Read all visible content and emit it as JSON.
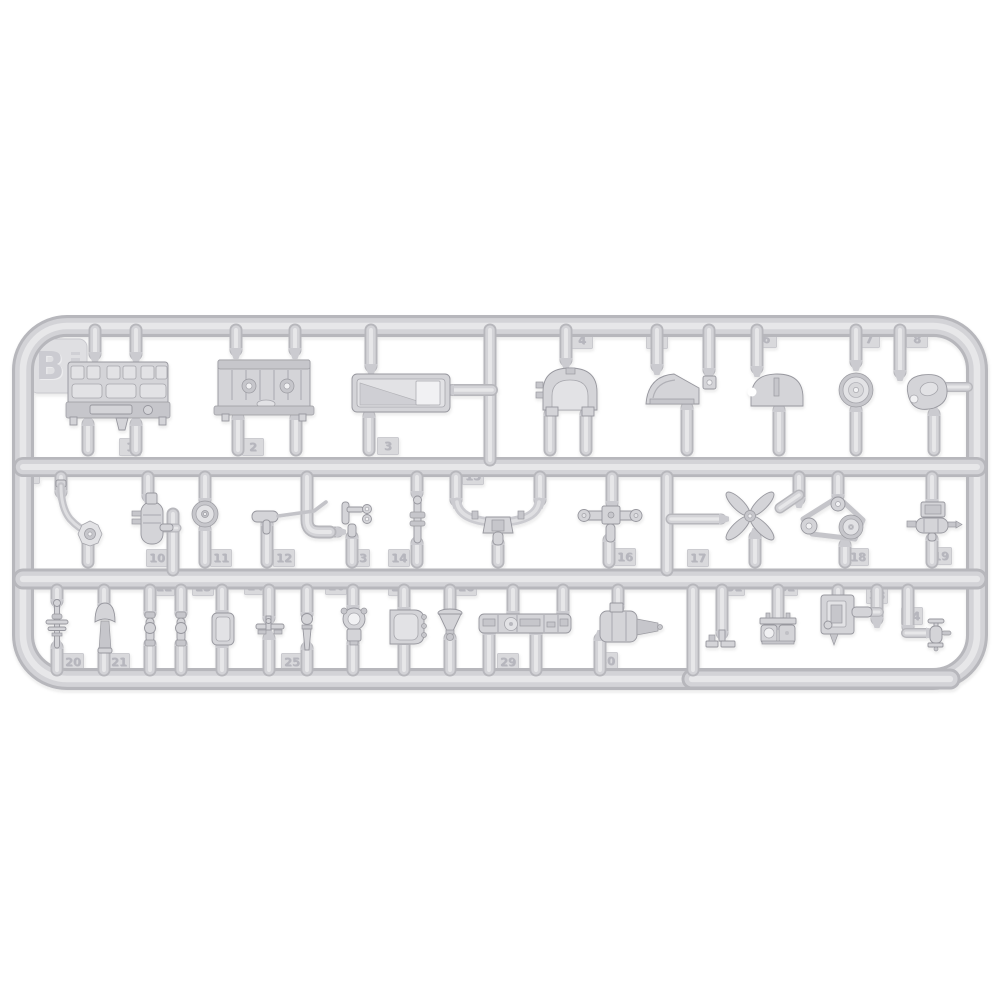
{
  "sprue": {
    "letter": "B",
    "tabs": [
      {
        "n": "1",
        "x": 130,
        "y": 447
      },
      {
        "n": "2",
        "x": 253,
        "y": 447
      },
      {
        "n": "3",
        "x": 388,
        "y": 446
      },
      {
        "n": "4",
        "x": 582,
        "y": 340
      },
      {
        "n": "5",
        "x": 657,
        "y": 340
      },
      {
        "n": "6",
        "x": 766,
        "y": 339
      },
      {
        "n": "7",
        "x": 869,
        "y": 339
      },
      {
        "n": "8",
        "x": 917,
        "y": 339
      },
      {
        "n": "9",
        "x": 29,
        "y": 475
      },
      {
        "n": "10",
        "x": 157,
        "y": 558
      },
      {
        "n": "11",
        "x": 221,
        "y": 558
      },
      {
        "n": "12",
        "x": 284,
        "y": 558
      },
      {
        "n": "13",
        "x": 359,
        "y": 558
      },
      {
        "n": "14",
        "x": 399,
        "y": 558
      },
      {
        "n": "15",
        "x": 473,
        "y": 476
      },
      {
        "n": "16",
        "x": 625,
        "y": 557
      },
      {
        "n": "17",
        "x": 698,
        "y": 558
      },
      {
        "n": "18",
        "x": 858,
        "y": 557
      },
      {
        "n": "19",
        "x": 941,
        "y": 556
      },
      {
        "n": "20",
        "x": 73,
        "y": 662
      },
      {
        "n": "21",
        "x": 119,
        "y": 662
      },
      {
        "n": "22",
        "x": 164,
        "y": 587
      },
      {
        "n": "23",
        "x": 203,
        "y": 587
      },
      {
        "n": "24",
        "x": 255,
        "y": 586
      },
      {
        "n": "25",
        "x": 292,
        "y": 662
      },
      {
        "n": "26",
        "x": 336,
        "y": 586
      },
      {
        "n": "27",
        "x": 399,
        "y": 587
      },
      {
        "n": "28",
        "x": 466,
        "y": 587
      },
      {
        "n": "29",
        "x": 508,
        "y": 662
      },
      {
        "n": "30",
        "x": 607,
        "y": 661
      },
      {
        "n": "31",
        "x": 734,
        "y": 587
      },
      {
        "n": "32",
        "x": 787,
        "y": 587
      },
      {
        "n": "33",
        "x": 877,
        "y": 595
      },
      {
        "n": "34",
        "x": 912,
        "y": 616
      }
    ],
    "parts": [
      {
        "num": 1,
        "name": "engine-cylinder-head"
      },
      {
        "num": 2,
        "name": "engine-block"
      },
      {
        "num": 3,
        "name": "oil-sump-pan"
      },
      {
        "num": 4,
        "name": "flywheel-housing"
      },
      {
        "num": 5,
        "name": "side-cover"
      },
      {
        "num": 6,
        "name": "semicircular-cover"
      },
      {
        "num": 7,
        "name": "pulley-wheel"
      },
      {
        "num": 8,
        "name": "mount-plate"
      },
      {
        "num": 9,
        "name": "exhaust-elbow-pipe"
      },
      {
        "num": 10,
        "name": "oil-filter-canister"
      },
      {
        "num": 11,
        "name": "small-pulley"
      },
      {
        "num": 12,
        "name": "control-rod-pipe"
      },
      {
        "num": 13,
        "name": "clamp-bracket"
      },
      {
        "num": 14,
        "name": "small-linkage"
      },
      {
        "num": 15,
        "name": "intake-manifold"
      },
      {
        "num": 16,
        "name": "handle-bar"
      },
      {
        "num": 17,
        "name": "cooling-fan"
      },
      {
        "num": 18,
        "name": "belt-pulley-set"
      },
      {
        "num": 19,
        "name": "generator"
      },
      {
        "num": 20,
        "name": "valve-linkage"
      },
      {
        "num": 21,
        "name": "air-horn"
      },
      {
        "num": 22,
        "name": "link-barrel-a"
      },
      {
        "num": 23,
        "name": "link-barrel-b"
      },
      {
        "num": 24,
        "name": "cover-plate"
      },
      {
        "num": 25,
        "name": "small-bracket"
      },
      {
        "num": 26,
        "name": "finial-knob"
      },
      {
        "num": 27,
        "name": "filler-clamp"
      },
      {
        "num": 28,
        "name": "access-cover"
      },
      {
        "num": 29,
        "name": "funnel"
      },
      {
        "num": 30,
        "name": "manifold-rail"
      },
      {
        "num": 31,
        "name": "starter-motor"
      },
      {
        "num": 32,
        "name": "pedal-base"
      },
      {
        "num": 33,
        "name": "twin-carburetor"
      },
      {
        "num": 34,
        "name": "magneto"
      }
    ]
  },
  "render": {
    "colors": {
      "tube_dark": "#b7b7bc",
      "tube_mid": "#d3d3d7",
      "tube_hi": "#e7e7e9",
      "gate": "#cbcbd0"
    },
    "frame": {
      "d": "M67,326 H933 A44,44 0 0 1 977,370 V635 A44,44 0 0 1 933,679 H67 A44,44 0 0 1 23,635 V370 A44,44 0 0 1 67,326 Z",
      "w": 22
    },
    "rails": [
      {
        "d": "M23,467 H977",
        "w": 20
      },
      {
        "d": "M23,579 H977",
        "w": 21
      },
      {
        "d": "M692,679 H950",
        "w": 21
      }
    ],
    "runners": [
      [
        95,
        330,
        354,
        "d"
      ],
      [
        136,
        330,
        354,
        "d"
      ],
      [
        88,
        424,
        450,
        "u"
      ],
      [
        136,
        424,
        450,
        "u"
      ],
      [
        236,
        330,
        350,
        "d"
      ],
      [
        295,
        330,
        350,
        "d"
      ],
      [
        238,
        418,
        450,
        "u"
      ],
      [
        296,
        418,
        450,
        "u"
      ],
      [
        371,
        330,
        366,
        "d"
      ],
      [
        369,
        416,
        450,
        "u"
      ],
      [
        490,
        330,
        460,
        0
      ],
      [
        566,
        330,
        360,
        "d"
      ],
      [
        550,
        414,
        450,
        "u"
      ],
      [
        586,
        414,
        450,
        "u"
      ],
      [
        657,
        330,
        366,
        "d"
      ],
      [
        687,
        408,
        450,
        "u"
      ],
      [
        709,
        330,
        370,
        "d"
      ],
      [
        757,
        330,
        368,
        "d"
      ],
      [
        779,
        410,
        450,
        "u"
      ],
      [
        856,
        330,
        362,
        "d"
      ],
      [
        856,
        410,
        450,
        "u"
      ],
      [
        900,
        330,
        372,
        "d"
      ],
      [
        934,
        414,
        450,
        "u"
      ],
      [
        61,
        477,
        492,
        "d"
      ],
      [
        88,
        540,
        562,
        "u"
      ],
      [
        148,
        477,
        496,
        "d"
      ],
      [
        173,
        514,
        570,
        0
      ],
      [
        205,
        477,
        500,
        "d"
      ],
      [
        205,
        529,
        562,
        "u"
      ],
      [
        267,
        524,
        562,
        "u"
      ],
      [
        352,
        537,
        562,
        "u"
      ],
      [
        417,
        477,
        493,
        "d"
      ],
      [
        417,
        543,
        562,
        "u"
      ],
      [
        456,
        477,
        500,
        "d"
      ],
      [
        540,
        477,
        500,
        "d"
      ],
      [
        498,
        543,
        562,
        "u"
      ],
      [
        612,
        477,
        503,
        "d"
      ],
      [
        609,
        540,
        562,
        "u"
      ],
      [
        667,
        477,
        570,
        0
      ],
      [
        755,
        537,
        562,
        "u"
      ],
      [
        799,
        477,
        499,
        "d"
      ],
      [
        838,
        477,
        496,
        "d"
      ],
      [
        845,
        545,
        562,
        "u"
      ],
      [
        932,
        477,
        501,
        "d"
      ],
      [
        932,
        539,
        562,
        "u"
      ],
      [
        57,
        590,
        601,
        "d"
      ],
      [
        57,
        647,
        670,
        "u"
      ],
      [
        104,
        590,
        605,
        "d"
      ],
      [
        104,
        651,
        670,
        "u"
      ],
      [
        150,
        590,
        613,
        "d"
      ],
      [
        150,
        644,
        670,
        "u"
      ],
      [
        181,
        590,
        613,
        "d"
      ],
      [
        181,
        644,
        670,
        "u"
      ],
      [
        222,
        590,
        612,
        "d"
      ],
      [
        222,
        646,
        670,
        "u"
      ],
      [
        269,
        590,
        618,
        "d"
      ],
      [
        269,
        638,
        670,
        "u"
      ],
      [
        307,
        590,
        614,
        "d"
      ],
      [
        307,
        648,
        670,
        "u"
      ],
      [
        353,
        590,
        607,
        "d"
      ],
      [
        353,
        643,
        670,
        "u"
      ],
      [
        404,
        590,
        609,
        "d"
      ],
      [
        404,
        643,
        670,
        "u"
      ],
      [
        450,
        590,
        611,
        "d"
      ],
      [
        450,
        638,
        670,
        "u"
      ],
      [
        513,
        590,
        613,
        "d"
      ],
      [
        563,
        590,
        613,
        "d"
      ],
      [
        489,
        633,
        670,
        "u"
      ],
      [
        536,
        633,
        670,
        "u"
      ],
      [
        618,
        590,
        607,
        "d"
      ],
      [
        600,
        639,
        670,
        "u"
      ],
      [
        693,
        590,
        670,
        0
      ],
      [
        722,
        590,
        633,
        "d"
      ],
      [
        778,
        590,
        621,
        "d"
      ],
      [
        838,
        590,
        597,
        "d"
      ],
      [
        877,
        590,
        619,
        "d"
      ],
      [
        908,
        590,
        627,
        "d"
      ]
    ],
    "hrunners": [
      [
        390,
        452,
        492,
        "l",
        12
      ],
      [
        387,
        944,
        968,
        "l",
        10
      ],
      [
        528,
        161,
        177,
        "l",
        9
      ],
      [
        519,
        671,
        721,
        "r",
        11
      ],
      [
        612,
        851,
        879,
        "l",
        10
      ],
      [
        633,
        906,
        928,
        "r",
        10
      ],
      [
        532,
        328,
        338,
        "r",
        11
      ]
    ],
    "extra_tubes": [
      {
        "d": "M307,477 L307,520 Q307,532 319,532 L330,532",
        "w": 13
      },
      {
        "d": "M799,495 L780,508",
        "w": 11
      }
    ]
  }
}
